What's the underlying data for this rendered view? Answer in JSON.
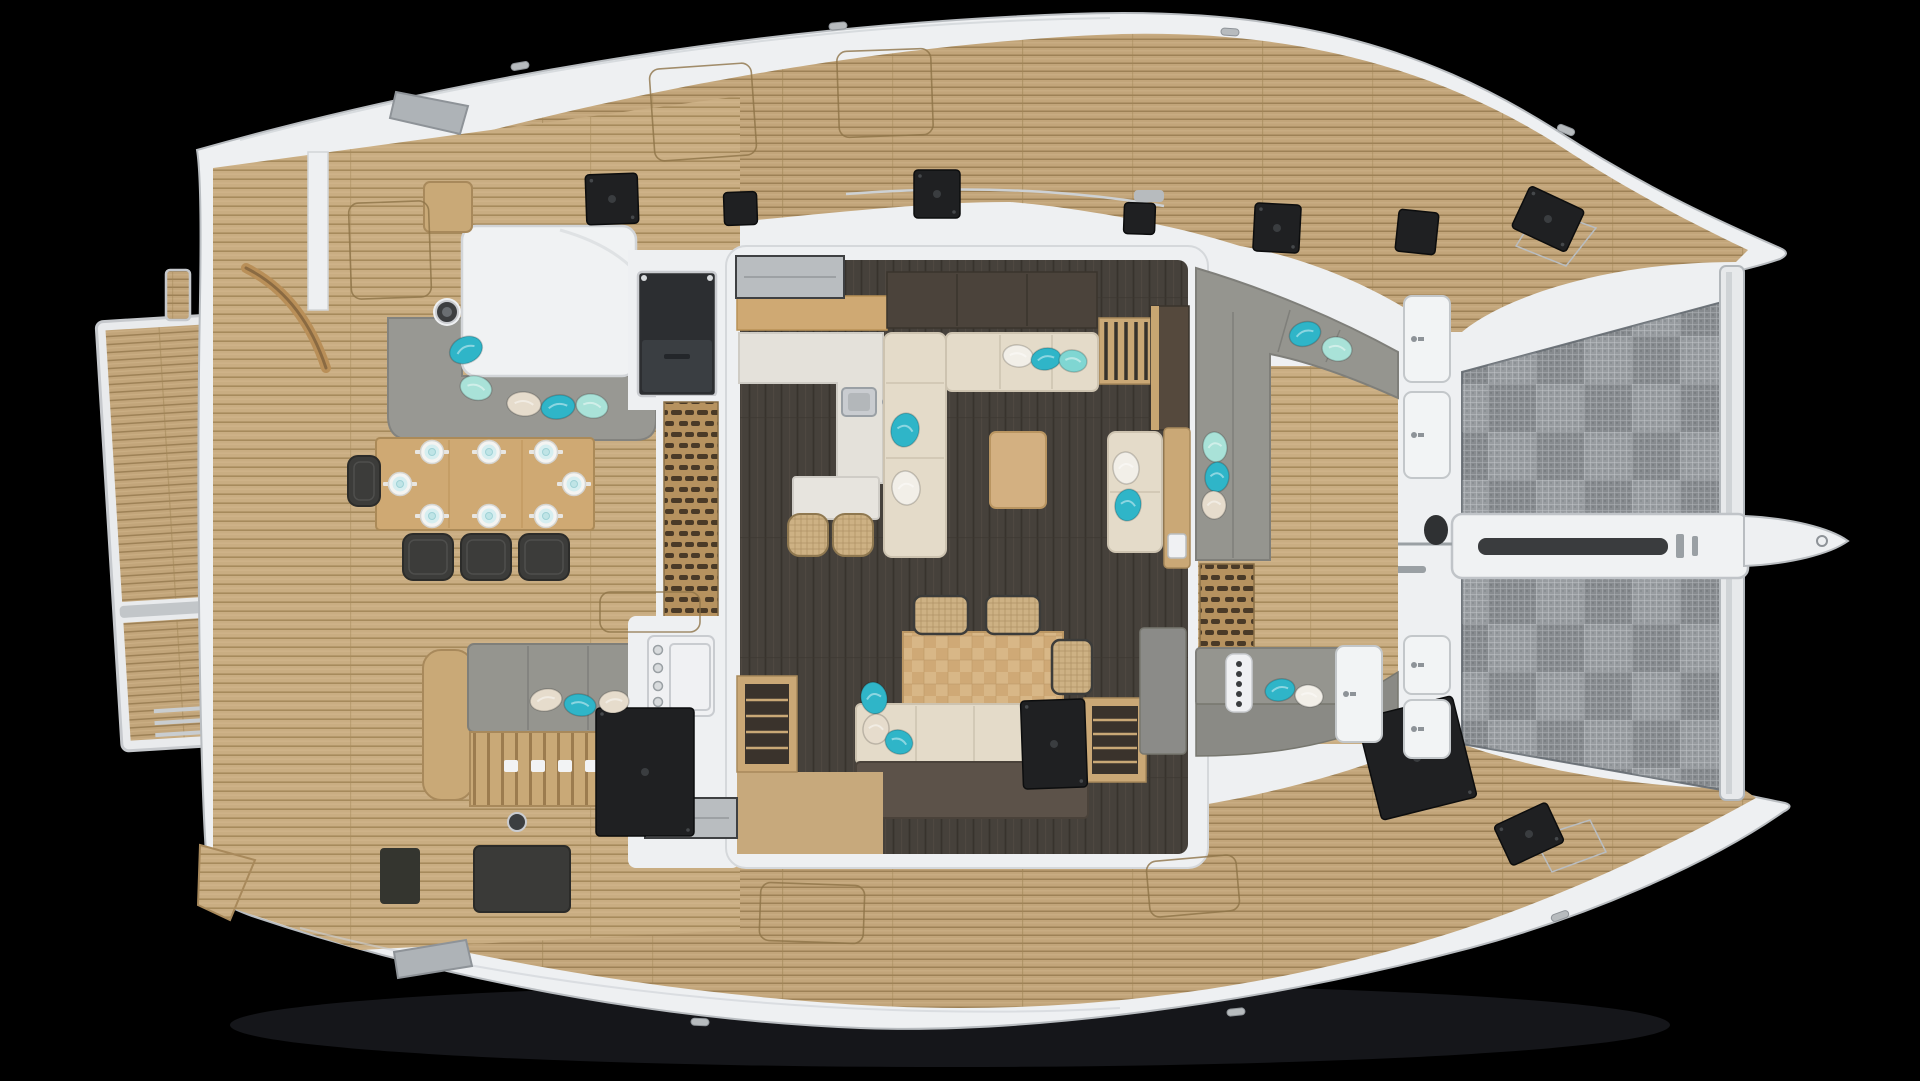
{
  "scene": {
    "type": "yacht-deck-plan",
    "subject": "catamaran sailing yacht, top-down exterior deck view",
    "bow_direction": "right",
    "background": "#000000"
  },
  "palette": {
    "hull_white": "#eef0f2",
    "hull_edge": "#c9ccd0",
    "teak": "#c2a57a",
    "teak_line": "#9d8156",
    "teak_cockpit": "#c9ad82",
    "grate_wood": "#b6925f",
    "grate_slot": "#4a3a27",
    "salon_floor": "#46413b",
    "marble": "#e4e1da",
    "wood_furniture": "#cfa973",
    "parquet": "#d8b787",
    "cabinet_dark": "#4b433b",
    "sofa_cream": "#e4dbc9",
    "sofa_gray": "#95958f",
    "backrest_brown": "#5c5249",
    "chair_dark": "#3c3c3a",
    "door_gray": "#b9bdc0",
    "hatch_black": "#1f2022",
    "mesh_gray": "#8f9498",
    "pillow_teal": "#2fb5c8",
    "pillow_light": "#7fd6d2",
    "pillow_mint": "#a9e2d8",
    "pillow_beige": "#e6dccc",
    "pillow_white": "#f2efe8"
  },
  "counts": {
    "aft_place_settings": 8,
    "aft_dining_chairs": 4,
    "salon_dining_chairs": 3,
    "bar_stools": 2,
    "scatter_pillows": 25,
    "black_deck_hatches": 11,
    "white_locker_hatches": 5,
    "trampoline_panels": 2
  },
  "aft_table": {
    "x": 376,
    "y": 438,
    "w": 218,
    "h": 92
  },
  "plates": [
    [
      432,
      452
    ],
    [
      489,
      452
    ],
    [
      546,
      452
    ],
    [
      400,
      484
    ],
    [
      574,
      484
    ],
    [
      432,
      516
    ],
    [
      489,
      516
    ],
    [
      546,
      516
    ]
  ],
  "aft_chairs": [
    {
      "x": 403,
      "y": 534,
      "w": 50,
      "h": 46
    },
    {
      "x": 461,
      "y": 534,
      "w": 50,
      "h": 46
    },
    {
      "x": 519,
      "y": 534,
      "w": 50,
      "h": 46
    },
    {
      "x": 348,
      "y": 456,
      "w": 32,
      "h": 50
    }
  ],
  "salon_chairs": [
    {
      "x": 914,
      "y": 596,
      "w": 54,
      "h": 38
    },
    {
      "x": 986,
      "y": 596,
      "w": 54,
      "h": 38
    },
    {
      "x": 1052,
      "y": 640,
      "w": 40,
      "h": 54
    }
  ],
  "bar_stools": [
    {
      "x": 788,
      "y": 514,
      "w": 40,
      "h": 42
    },
    {
      "x": 833,
      "y": 514,
      "w": 40,
      "h": 42
    }
  ],
  "hatches_black": [
    {
      "x": 586,
      "y": 174,
      "w": 52,
      "h": 50,
      "rot": -2
    },
    {
      "x": 724,
      "y": 192,
      "w": 33,
      "h": 33,
      "rot": -2
    },
    {
      "x": 914,
      "y": 170,
      "w": 46,
      "h": 48,
      "rot": 0
    },
    {
      "x": 1124,
      "y": 203,
      "w": 31,
      "h": 31,
      "rot": 2
    },
    {
      "x": 1254,
      "y": 204,
      "w": 46,
      "h": 48,
      "rot": 3
    },
    {
      "x": 1397,
      "y": 211,
      "w": 40,
      "h": 42,
      "rot": 6
    },
    {
      "x": 1518,
      "y": 196,
      "w": 60,
      "h": 46,
      "rot": 25
    },
    {
      "x": 596,
      "y": 708,
      "w": 98,
      "h": 128,
      "rot": 0
    },
    {
      "x": 1022,
      "y": 700,
      "w": 64,
      "h": 88,
      "rot": -2
    },
    {
      "x": 1368,
      "y": 706,
      "w": 98,
      "h": 104,
      "rot": -14
    },
    {
      "x": 1500,
      "y": 812,
      "w": 58,
      "h": 44,
      "rot": -25
    }
  ],
  "hatch_outlines": [
    {
      "x": 652,
      "y": 66,
      "w": 102,
      "h": 92,
      "rot": -4
    },
    {
      "x": 838,
      "y": 50,
      "w": 94,
      "h": 86,
      "rot": -2
    },
    {
      "x": 350,
      "y": 202,
      "w": 80,
      "h": 96,
      "rot": -2
    },
    {
      "x": 600,
      "y": 592,
      "w": 100,
      "h": 40,
      "rot": 0
    },
    {
      "x": 760,
      "y": 884,
      "w": 104,
      "h": 58,
      "rot": 2
    },
    {
      "x": 1148,
      "y": 858,
      "w": 90,
      "h": 56,
      "rot": -5
    }
  ],
  "white_hatches": [
    {
      "x": 1404,
      "y": 296,
      "w": 46,
      "h": 86
    },
    {
      "x": 1404,
      "y": 392,
      "w": 46,
      "h": 86
    },
    {
      "x": 1404,
      "y": 636,
      "w": 46,
      "h": 58
    },
    {
      "x": 1404,
      "y": 700,
      "w": 46,
      "h": 58
    },
    {
      "x": 1336,
      "y": 646,
      "w": 46,
      "h": 96
    }
  ],
  "cleats": [
    {
      "x": 520,
      "y": 66,
      "rot": -10
    },
    {
      "x": 838,
      "y": 26,
      "rot": -5
    },
    {
      "x": 1230,
      "y": 32,
      "rot": 4
    },
    {
      "x": 1566,
      "y": 130,
      "rot": 22
    },
    {
      "x": 700,
      "y": 1022,
      "rot": 3
    },
    {
      "x": 1236,
      "y": 1012,
      "rot": -6
    },
    {
      "x": 1560,
      "y": 916,
      "rot": -20
    }
  ],
  "pillows": [
    {
      "x": 466,
      "y": 350,
      "rx": 17,
      "ry": 13,
      "rot": -25,
      "c": "teal"
    },
    {
      "x": 476,
      "y": 388,
      "rx": 16,
      "ry": 12,
      "rot": 15,
      "c": "mint"
    },
    {
      "x": 524,
      "y": 404,
      "rx": 17,
      "ry": 12,
      "rot": 5,
      "c": "beige"
    },
    {
      "x": 558,
      "y": 407,
      "rx": 17,
      "ry": 12,
      "rot": -8,
      "c": "teal"
    },
    {
      "x": 592,
      "y": 406,
      "rx": 16,
      "ry": 12,
      "rot": 10,
      "c": "mint"
    },
    {
      "x": 546,
      "y": 700,
      "rx": 16,
      "ry": 11,
      "rot": -10,
      "c": "beige"
    },
    {
      "x": 580,
      "y": 705,
      "rx": 16,
      "ry": 11,
      "rot": 8,
      "c": "teal"
    },
    {
      "x": 614,
      "y": 702,
      "rx": 15,
      "ry": 11,
      "rot": -6,
      "c": "beige"
    },
    {
      "x": 905,
      "y": 430,
      "rx": 14,
      "ry": 17,
      "rot": 12,
      "c": "teal"
    },
    {
      "x": 906,
      "y": 488,
      "rx": 14,
      "ry": 17,
      "rot": -8,
      "c": "white"
    },
    {
      "x": 1018,
      "y": 356,
      "rx": 15,
      "ry": 11,
      "rot": 6,
      "c": "white"
    },
    {
      "x": 1046,
      "y": 359,
      "rx": 15,
      "ry": 11,
      "rot": -10,
      "c": "teal"
    },
    {
      "x": 1073,
      "y": 361,
      "rx": 14,
      "ry": 11,
      "rot": 8,
      "c": "light"
    },
    {
      "x": 1126,
      "y": 468,
      "rx": 13,
      "ry": 16,
      "rot": -6,
      "c": "white"
    },
    {
      "x": 1128,
      "y": 505,
      "rx": 13,
      "ry": 16,
      "rot": 10,
      "c": "teal"
    },
    {
      "x": 874,
      "y": 698,
      "rx": 13,
      "ry": 16,
      "rot": -12,
      "c": "teal"
    },
    {
      "x": 876,
      "y": 729,
      "rx": 13,
      "ry": 15,
      "rot": 6,
      "c": "beige"
    },
    {
      "x": 899,
      "y": 742,
      "rx": 14,
      "ry": 12,
      "rot": 20,
      "c": "teal"
    },
    {
      "x": 1305,
      "y": 334,
      "rx": 16,
      "ry": 12,
      "rot": -18,
      "c": "teal"
    },
    {
      "x": 1337,
      "y": 349,
      "rx": 15,
      "ry": 12,
      "rot": 10,
      "c": "mint"
    },
    {
      "x": 1215,
      "y": 447,
      "rx": 12,
      "ry": 15,
      "rot": -8,
      "c": "mint"
    },
    {
      "x": 1217,
      "y": 477,
      "rx": 12,
      "ry": 15,
      "rot": 6,
      "c": "teal"
    },
    {
      "x": 1214,
      "y": 505,
      "rx": 12,
      "ry": 14,
      "rot": -4,
      "c": "beige"
    },
    {
      "x": 1280,
      "y": 690,
      "rx": 15,
      "ry": 11,
      "rot": -12,
      "c": "teal"
    },
    {
      "x": 1309,
      "y": 696,
      "rx": 14,
      "ry": 11,
      "rot": 8,
      "c": "white"
    }
  ]
}
